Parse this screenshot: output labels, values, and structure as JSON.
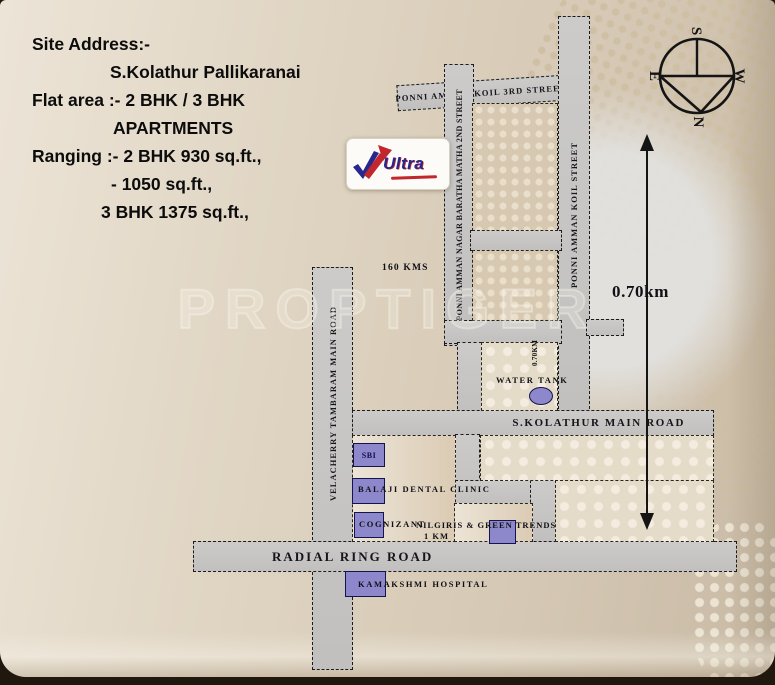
{
  "info_panel": {
    "line1": "Site Address:-",
    "line2": "S.Kolathur Pallikaranai",
    "line3": "Flat area :- 2 BHK / 3 BHK",
    "line4": "APARTMENTS",
    "line5": "Ranging :-  2 BHK 930 sq.ft.,",
    "line6": "- 1050 sq.ft.,",
    "line7": "3 BHK 1375 sq.ft.,"
  },
  "logo": {
    "brand": "Ultra"
  },
  "watermark": "PROPTIGER",
  "compass": {
    "north": "N",
    "south": "S",
    "east": "E",
    "west": "W"
  },
  "roads": {
    "ponni_amman_koil_3rd_street": "PONNI AMMAN KOIL 3RD STREET",
    "ponni_amman_nagar_baratha_matha_2nd_street": "PONNI AMMAN NAGAR BARATHA MATHA 2ND STREET",
    "ponni_amman_koil_street": "PONNI AMMAN KOIL STREET",
    "velacherry_tambaram_main_road": "VELACHERRY TAMBARAM MAIN ROAD",
    "s_kolathur_main_road": "S.KOLATHUR MAIN ROAD",
    "radial_ring_road": "RADIAL RING ROAD"
  },
  "distances": {
    "city_distance": "160 KMS",
    "koil_street_distance": "0.70km",
    "cross_street_distance": "0.70KM"
  },
  "landmarks": {
    "sbi": "SBI",
    "balaji_dental_clinic": "BALAJI DENTAL CLINIC",
    "cognizant": "COGNIZANT",
    "nilgiris_green_trends": "NILGIRIS & GREEN TRENDS",
    "nilgiris_distance": "1 KM",
    "kamakshmi_hospital": "KAMAKSHMI HOSPITAL",
    "water_tank": "WATER TANK"
  },
  "colors": {
    "road_fill": "#c7c5c3",
    "building_fill": "#8d87cb",
    "building_border": "#15154e",
    "background": "#d9cdbc",
    "accent_blue": "#28288c",
    "accent_red": "#c1272d"
  }
}
